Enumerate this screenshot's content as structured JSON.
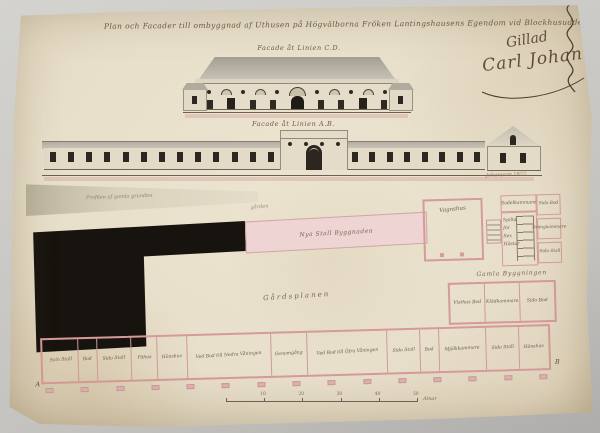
{
  "document": {
    "title": "Plan och Facader till ombyggnad af Uthusen på Högvälborna Fröken Lantingshausens Egendom vid Blockhusudden.",
    "facade_cd_caption": "Facade åt Linien C.D.",
    "facade_ab_caption": "Facade åt Linien A.B.",
    "approval_word": "Gillad",
    "approval_signature": "Carl Johan",
    "artist_signature": "Johansson 1822",
    "sketch_note": "Profilen af gamla grunden",
    "scale": {
      "ticks": [
        "10",
        "20",
        "30",
        "40",
        "50"
      ],
      "unit": "Alnar"
    }
  },
  "plan": {
    "new_building_label": "Nya Stall Byggnaden",
    "yard_note": "gården",
    "courtyard_label": "Gårdsplanen",
    "old_building_caption": "Gamla Byggningen",
    "stable_block": {
      "vagnshus": "Vagnshus",
      "sadelkammare": "Sadelkammare",
      "stall_lines": [
        "Spilta",
        "för",
        "Sex",
        "Hästar"
      ],
      "right_rooms": [
        "Sido Bod",
        "Drängkammare",
        "Sido Stall"
      ]
    },
    "store_rooms": [
      "Visthus Bod",
      "Klädkammare",
      "Sido Bod"
    ],
    "wing_rooms": [
      {
        "label": "Svin Stall",
        "w": 48
      },
      {
        "label": "Bod",
        "w": 26
      },
      {
        "label": "Sido Stall",
        "w": 40
      },
      {
        "label": "Fähus",
        "w": 40
      },
      {
        "label": "Hönshus",
        "w": 26
      },
      {
        "label": "Ved Bod till Nedra Våningen",
        "w": 64
      },
      {
        "label": "Genomgång",
        "w": 24
      },
      {
        "label": "Ved Bod till Öfra Våningen",
        "w": 64
      },
      {
        "label": "Sido Stall",
        "w": 36
      },
      {
        "label": "Bod",
        "w": 26
      },
      {
        "label": "Mjölkkammare",
        "w": 40
      },
      {
        "label": "Sido Stall",
        "w": 34
      },
      {
        "label": "Hönshus",
        "w": 28
      }
    ],
    "corner_a": "A",
    "corner_b": "B"
  },
  "facades": {
    "cd": {
      "frieze": [
        "o",
        "a",
        "o",
        "a",
        "o",
        "A",
        "o",
        "a",
        "o",
        "a",
        "o"
      ],
      "lower": [
        "w",
        "d",
        "w",
        "w",
        "D",
        "w",
        "w",
        "d",
        "w"
      ]
    },
    "ab": {
      "left_windows": 13,
      "right_windows": 8,
      "pavilion_oculi": 4
    }
  },
  "colors": {
    "paper": "#e8dfca",
    "ink": "#4a3e2e",
    "black_mass": "#17130e",
    "masonry_pink": "#d59a99",
    "new_wash_pink": "#eed4d3",
    "roof_gray": "#b3ada1"
  }
}
